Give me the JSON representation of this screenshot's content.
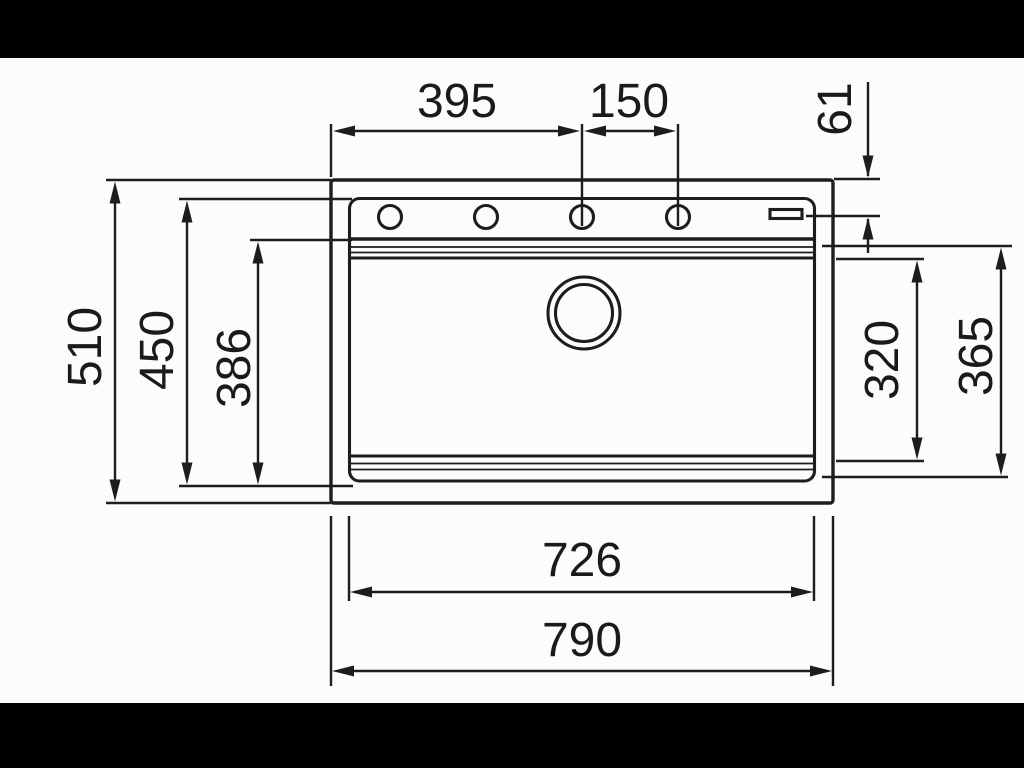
{
  "drawing": {
    "kind": "sink-installation-dimension-drawing",
    "colors": {
      "letterbox": "#000000",
      "background": "#fcfcfc",
      "line": "#1d1d1b",
      "text": "#1a1a1a"
    },
    "dims": {
      "faucet_offset": "395",
      "hole_spacing": "150",
      "waste_control_offset": "61",
      "overall_depth": "510",
      "rim_depth": "450",
      "bowl_ledge_depth": "386",
      "bowl_inner_depth": "320",
      "bowl_outer_depth": "365",
      "rim_width": "726",
      "overall_width": "790"
    }
  }
}
